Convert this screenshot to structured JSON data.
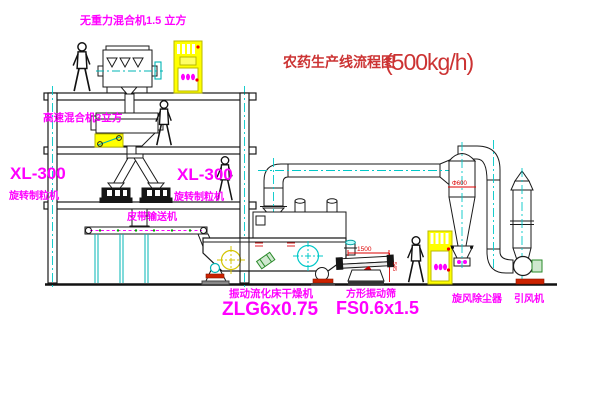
{
  "title": {
    "text": "农药生产线流程图",
    "capacity": "(500kg/h)"
  },
  "equipment_labels": {
    "gravity_free_mixer": "无重力混合机1.5 立方",
    "high_speed_mixer": "高速混合机3立方",
    "granulator_left_model": "XL-300",
    "granulator_left_name": "旋转制粒机",
    "granulator_mid_model": "XL-300",
    "granulator_mid_name": "旋转制粒机",
    "belt_conveyor": "皮带输送机",
    "dryer_name": "振动流化床干燥机",
    "dryer_model": "ZLG6x0.75",
    "screen_name": "方形振动筛",
    "screen_model": "FS0.6x1.5",
    "cyclone": "旋风除尘器",
    "fan": "引风机"
  },
  "dimensions": {
    "screen_length": "1500",
    "screen_height": "545",
    "cyclone_diameter": "Φ600"
  },
  "colors": {
    "label": "#ff00ff",
    "title": "#cc3333",
    "dimension": "#dd0000",
    "centerline": "#00c8c8",
    "cabinet": "#ffff00",
    "line": "#1a1a1a",
    "background": "#ffffff"
  }
}
